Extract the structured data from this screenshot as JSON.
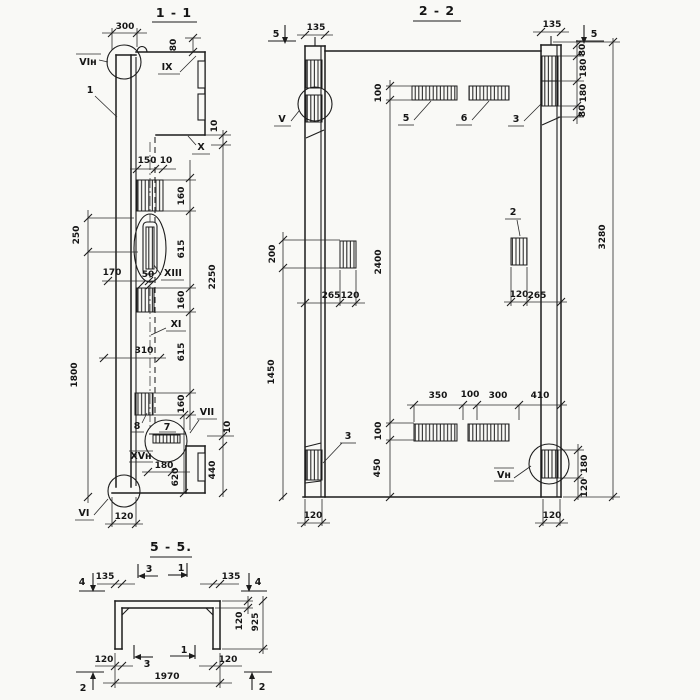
{
  "colors": {
    "ink": "#1c1c1c",
    "paper": "#f9f9f6"
  },
  "s11": {
    "title": "1 - 1",
    "labels": {
      "vi_n": "VIн",
      "one": "1",
      "ix": "IX",
      "x": "X",
      "xiii": "XIII",
      "xi": "XI",
      "eight": "8",
      "seven": "7",
      "vii": "VII",
      "xv_n": "XVн",
      "vi": "VI"
    },
    "dims": {
      "w300": "300",
      "h80": "80",
      "t10a": "10",
      "w150": "150",
      "w10": "10",
      "s160a": "160",
      "s615a": "615",
      "s160b": "160",
      "s615b": "615",
      "s160c": "160",
      "h2250": "2250",
      "h250": "250",
      "h1800": "1800",
      "w170": "170",
      "w50": "50",
      "w310": "310",
      "w180": "180",
      "h620": "620",
      "h440": "440",
      "t10b": "10",
      "w120": "120"
    }
  },
  "s22": {
    "title": "2 - 2",
    "labels": {
      "v": "V",
      "v_n": "Vн",
      "two": "2",
      "three_tr": "3",
      "three_bl": "3",
      "five": "5",
      "six": "6"
    },
    "marks": {
      "cut5_l": "5",
      "cut5_r": "5"
    },
    "dims": {
      "w135l": "135",
      "w135r": "135",
      "h100t": "100",
      "h2400": "2400",
      "h100b": "100",
      "h450": "450",
      "h200": "200",
      "h1450": "1450",
      "w350": "350",
      "w100": "100",
      "w300": "300",
      "w410": "410",
      "h80a": "80",
      "h180a": "180",
      "h180b": "180",
      "h80b": "80",
      "h3280": "3280",
      "w265l": "265",
      "w120l": "120",
      "w120r": "120",
      "w265r": "265",
      "h180r": "180",
      "h120r": "120",
      "w120bl": "120",
      "w120br": "120"
    }
  },
  "s55": {
    "title": "5 - 5.",
    "marks": {
      "cut4_l": "4",
      "cut4_r": "4",
      "cut3_t": "3",
      "cut1_t": "1",
      "cut3_b": "3",
      "cut1_b": "1",
      "cut2_l": "2",
      "cut2_r": "2"
    },
    "dims": {
      "w135l": "135",
      "w135r": "135",
      "t120": "120",
      "h925": "925",
      "w120l": "120",
      "w120r": "120",
      "w1970": "1970"
    }
  }
}
